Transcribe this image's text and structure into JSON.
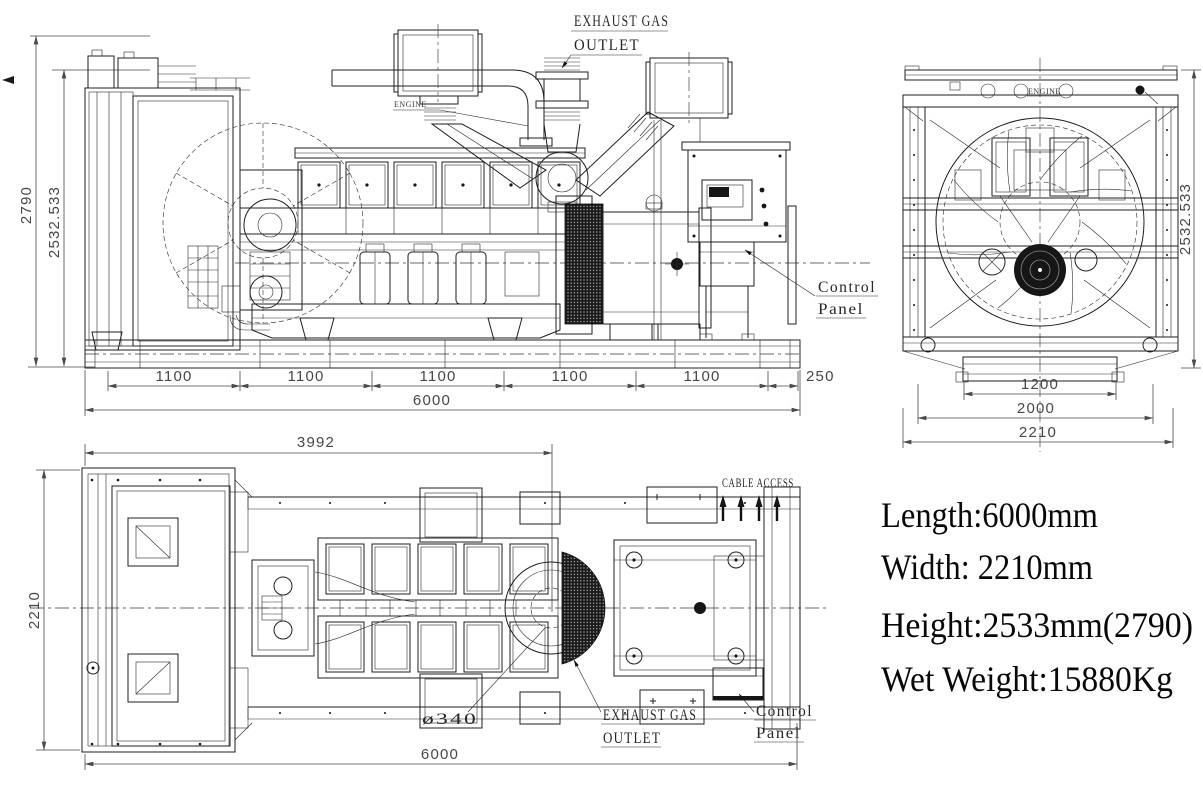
{
  "side_view": {
    "dim_height_overall": "2790",
    "dim_height_canopy": "2532.533",
    "dim_segments": [
      "1100",
      "1100",
      "1100",
      "1100",
      "1100"
    ],
    "dim_end_segment": "250",
    "dim_total_length": "6000",
    "label_exhaust_line1": "EXHAUST GAS",
    "label_exhaust_line2": "OUTLET",
    "label_engine": "ENGINE",
    "label_control_line1": "Control",
    "label_control_line2": "Panel"
  },
  "end_view": {
    "dim_height": "2532.533",
    "dim_base_width": "1200",
    "dim_frame_width": "2000",
    "dim_overall_width": "2210",
    "label_engine": "ENGINE"
  },
  "plan_view": {
    "dim_engine_length": "3992",
    "dim_overall_width": "2210",
    "dim_total_length": "6000",
    "label_cable_access": "CABLE ACCESS",
    "label_outlet_diameter": "ø340",
    "label_exhaust_line1": "EXHAUST GAS",
    "label_exhaust_line2": "OUTLET",
    "label_control_line1": "Control",
    "label_control_line2": "Panel"
  },
  "specs": {
    "length": "Length:6000mm",
    "width": "Width: 2210mm",
    "height": "Height:2533mm(2790)",
    "weight": "Wet Weight:15880Kg"
  },
  "colors": {
    "line": "#1f1f1f",
    "dimension": "#4a4a4a",
    "background": "#ffffff"
  }
}
